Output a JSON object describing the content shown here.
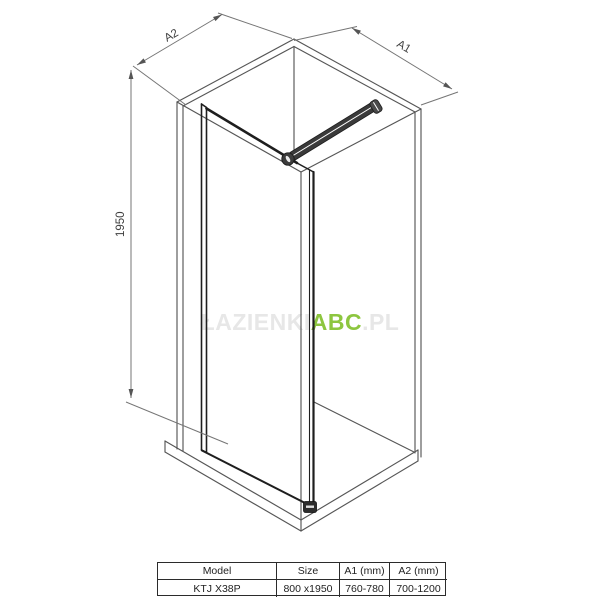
{
  "drawing": {
    "labels": {
      "a1": "A1",
      "a2": "A2",
      "height": "1950"
    }
  },
  "watermark": {
    "prefix": "ŁAZIENKI",
    "brand": "ABC",
    "suffix": ".PL"
  },
  "spec_table": {
    "headers": [
      "Model",
      "Size",
      "A1 (mm)",
      "A2 (mm)"
    ],
    "row": [
      "KTJ X38P",
      "800 x1950",
      "760-780",
      "700-1200"
    ]
  },
  "colors": {
    "accent_green": "#8dc63f",
    "watermark_faint": "#e7e7e7",
    "wireframe_line": "#565656",
    "hardware_dark": "#1e1e1e",
    "dimension_line": "#757575",
    "dimension_text": "#3f3f3f",
    "table_line": "#2b2b2b"
  }
}
